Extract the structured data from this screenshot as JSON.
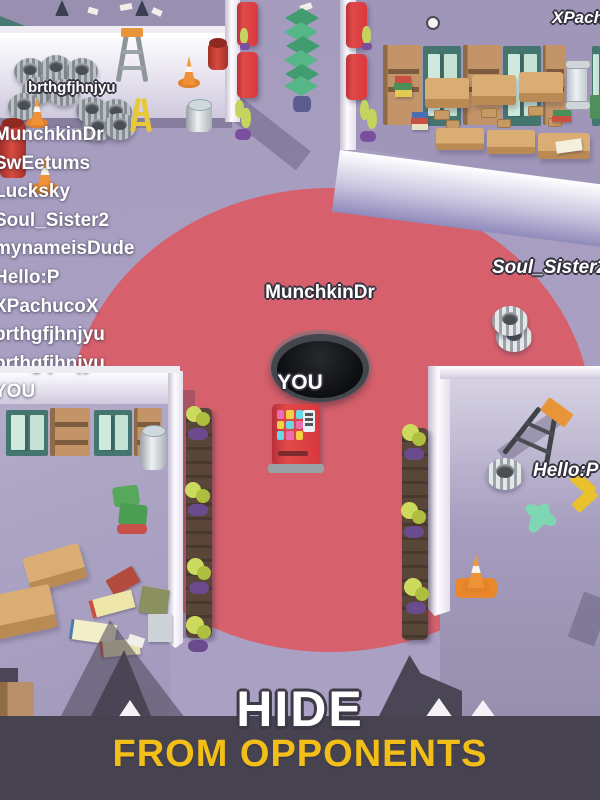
{
  "hud": {
    "leaderboard": [
      "MunchkinDr",
      "SwEetums",
      "Lucksky",
      "Soul_Sister2",
      "mynameisDude",
      "Hello:P",
      "XPachucoX",
      "brthgfjhnjyu",
      "brthgfjhnjyu",
      "YOU"
    ]
  },
  "labels": {
    "garage_player": "brthgfjhnjyu",
    "center_player": "MunchkinDr",
    "right_player": "Soul_Sister2",
    "top_right_player": "XPachucoX",
    "lower_right_player": "Hello:P",
    "you": "YOU"
  },
  "banner": {
    "line1": "HIDE",
    "line2": "FROM OPPONENTS"
  },
  "colors": {
    "floor": "#a89fc2",
    "reveal_zone": "#d6616c",
    "wall": "#f2eff6",
    "banner_bg": "#474250",
    "headline_white": "#ffffff",
    "headline_yellow": "#f2be18",
    "hole": "#0d0e11"
  }
}
